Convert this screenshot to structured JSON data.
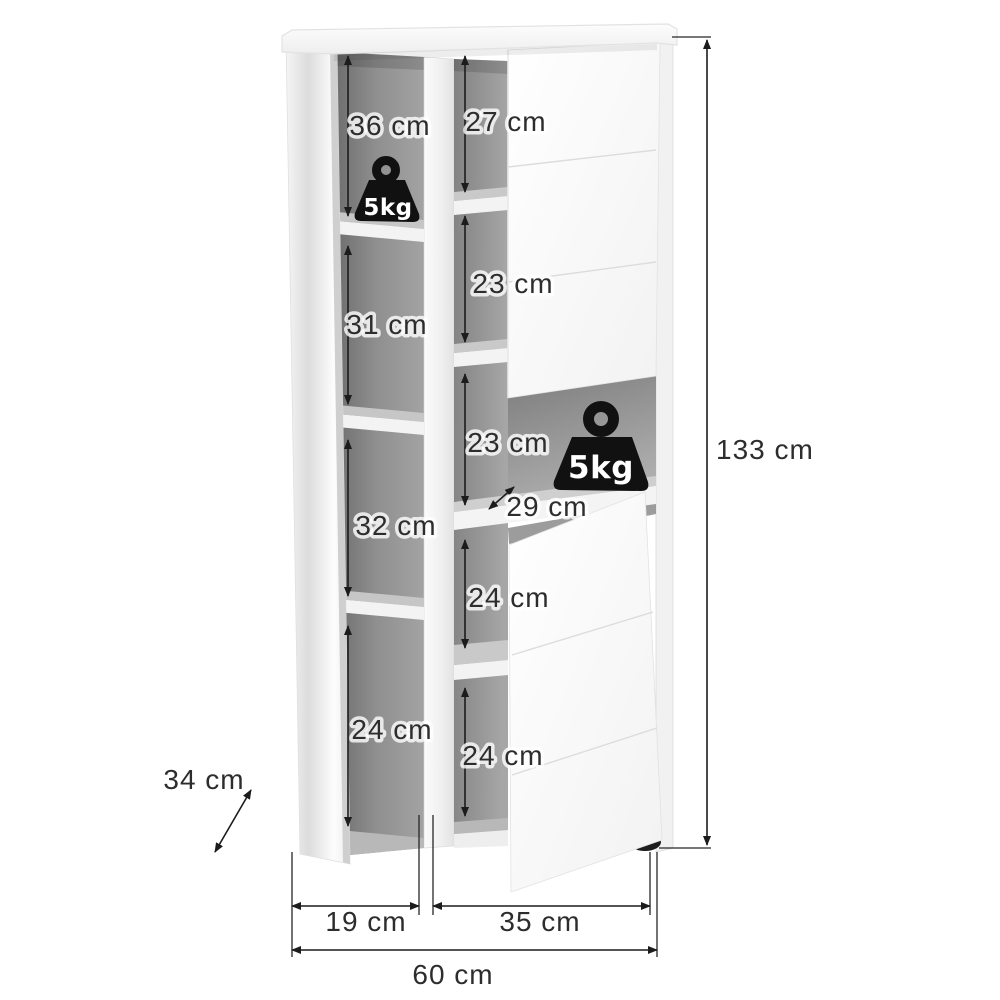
{
  "diagram": {
    "subject": "Tall two-door cabinet with open shelf compartments, shown with dimension annotations",
    "unit": "cm",
    "overall": {
      "height": "133 cm",
      "width": "60 cm",
      "depth": "34 cm"
    },
    "compartments": {
      "left_1": "36 cm",
      "left_2": "31 cm",
      "left_3": "32 cm",
      "left_4": "24 cm",
      "middle_1": "27 cm",
      "middle_2": "23 cm",
      "middle_3": "23 cm",
      "middle_4": "24 cm",
      "middle_5": "24 cm",
      "niche_depth": "29 cm"
    },
    "door_widths": {
      "left": "19 cm",
      "right": "35 cm"
    },
    "load_limits": {
      "upper_shelf": "5kg",
      "niche_shelf": "5kg"
    },
    "colors": {
      "background": "#ffffff",
      "interior_gray": "#8f8f8f",
      "panel_white": "#f5f5f5",
      "annotation": "#1c1c1c",
      "weight_icon": "#121212"
    }
  }
}
